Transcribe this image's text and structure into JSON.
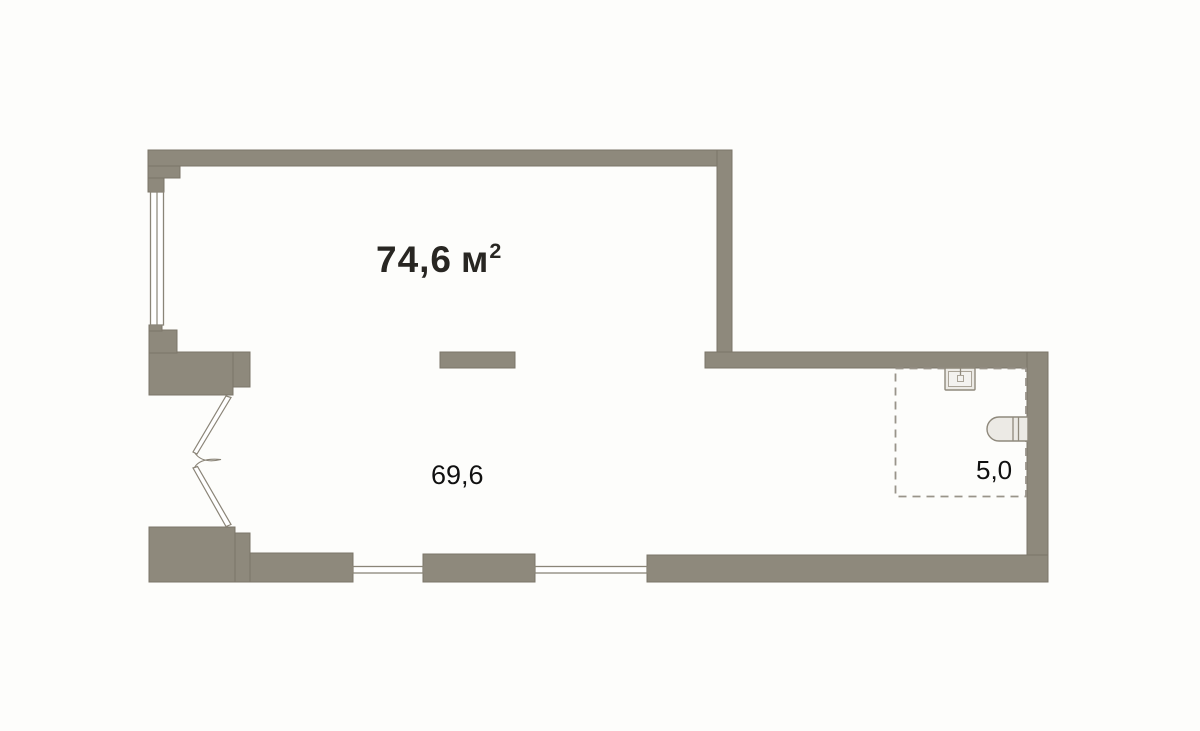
{
  "plan": {
    "total_area": {
      "value": "74,6",
      "unit": "м",
      "superscript": "2"
    },
    "rooms": [
      {
        "name": "main-room",
        "area": "69,6"
      },
      {
        "name": "bathroom",
        "area": "5,0"
      }
    ],
    "fixtures": [
      {
        "icon": "sink-icon"
      },
      {
        "icon": "toilet-icon"
      }
    ]
  },
  "colors": {
    "background": "#fdfdfb",
    "wall-fill": "#8e897c",
    "wall-stroke": "#7b7568",
    "window-stroke": "#8a8578",
    "dash": "#99948a",
    "fixture-fill": "#eceae5",
    "fixture-inner": "#f3f2ef",
    "fixture-stroke": "#8f897c",
    "door-stroke": "#8a8477",
    "text-dark": "#282622",
    "text-black": "#101010"
  }
}
